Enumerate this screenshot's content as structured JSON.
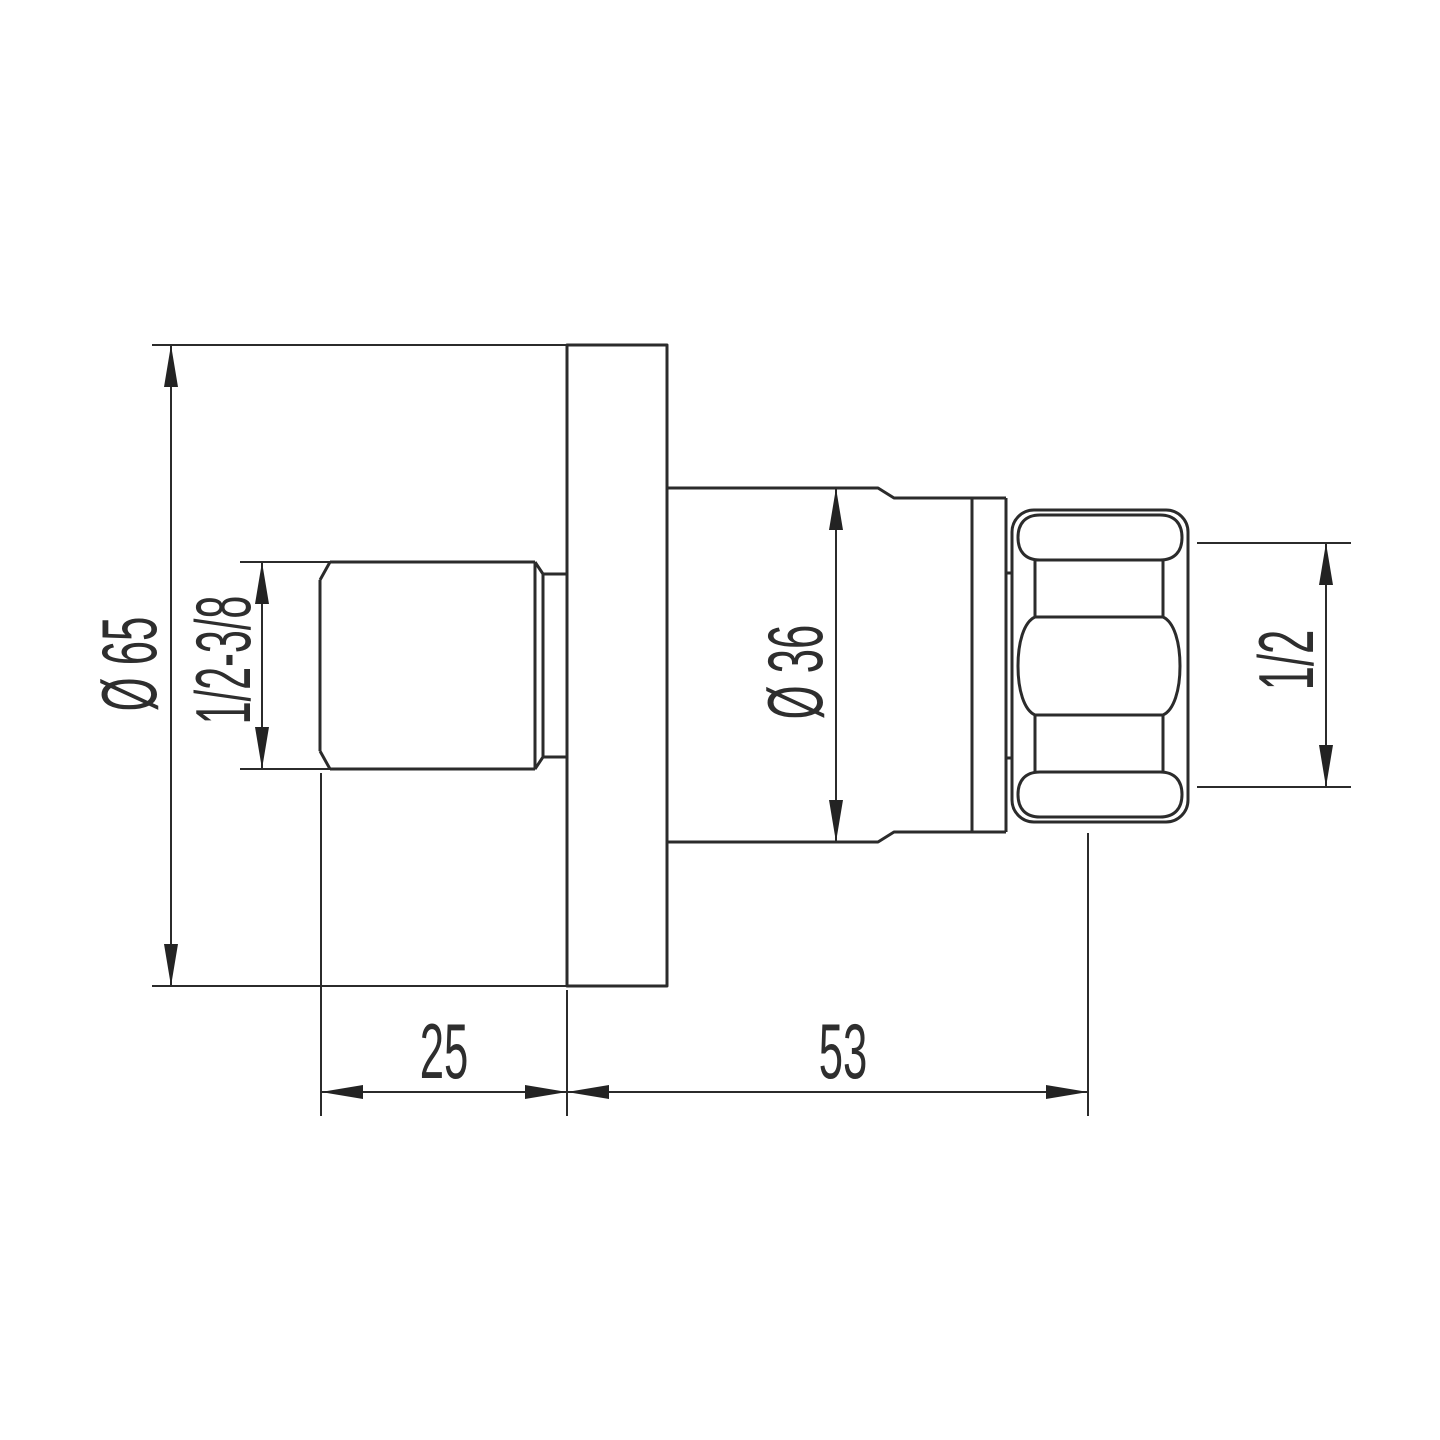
{
  "drawing": {
    "type": "technical-dimension-drawing",
    "subject": "wall-mounted valve fitting side view",
    "background_color": "#ffffff",
    "line_color": "#2b2b2b",
    "text_color": "#2e2e2e",
    "dimensions": {
      "flange_diameter": {
        "label": "Ø 65"
      },
      "inlet_thread": {
        "label": "1/2-3/8"
      },
      "body_diameter": {
        "label": "Ø 36"
      },
      "outlet_thread": {
        "label": "1/2"
      },
      "flange_offset": {
        "label": "25"
      },
      "body_length": {
        "label": "53"
      }
    }
  }
}
